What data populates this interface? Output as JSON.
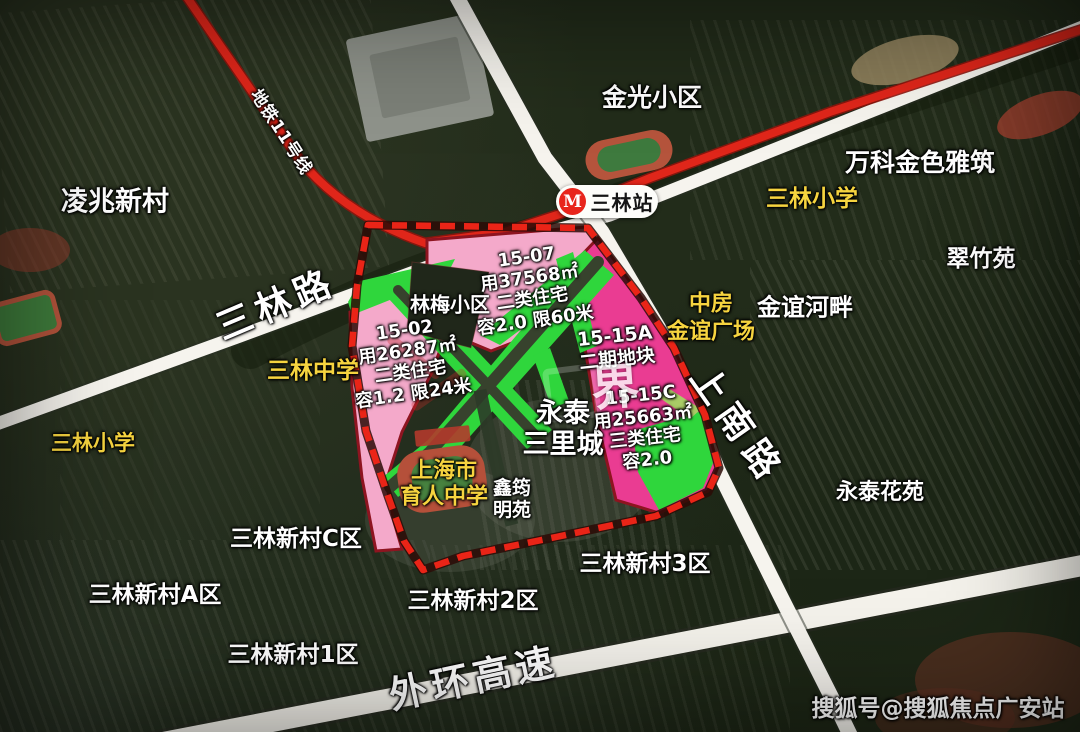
{
  "metro": {
    "line_label": "地铁11号线",
    "station_name": "三林站"
  },
  "roads": [
    {
      "id": "road-sanlin",
      "name": "三林路"
    },
    {
      "id": "road-shangnan",
      "name": "上南路"
    },
    {
      "id": "road-waihuan",
      "name": "外环高速"
    }
  ],
  "parcels": [
    {
      "id": "parcel-15-07",
      "lines": [
        "15-07",
        "用37568㎡",
        "二类住宅",
        "容2.0 限60米"
      ]
    },
    {
      "id": "parcel-15-02",
      "lines": [
        "15-02",
        "用26287㎡",
        "二类住宅",
        "容1.2 限24米"
      ]
    },
    {
      "id": "parcel-15-15A",
      "lines": [
        "15-15A",
        "二期地块"
      ]
    },
    {
      "id": "parcel-15-15C",
      "lines": [
        "15-15C",
        "用25663㎡",
        "三类住宅",
        "容2.0"
      ]
    }
  ],
  "places": [
    {
      "id": "lingzhao-xincun",
      "text": "凌兆新村"
    },
    {
      "id": "jinguang-xiaoqu",
      "text": "金光小区"
    },
    {
      "id": "wanke-jinse-yazhu",
      "text": "万科金色雅筑"
    },
    {
      "id": "sanlin-xiaoxue-east",
      "text": "三林小学",
      "color": "yellow"
    },
    {
      "id": "cuizhu-yuan",
      "text": "翠竹苑"
    },
    {
      "id": "zhongfang-jinyi-guangchang",
      "lines": [
        "中房",
        "金谊广场"
      ],
      "color": "yellow"
    },
    {
      "id": "jinyi-hepan",
      "text": "金谊河畔"
    },
    {
      "id": "linmei-xiaoqu",
      "text": "林梅小区"
    },
    {
      "id": "sanlin-zhongxue",
      "text": "三林中学",
      "color": "yellow"
    },
    {
      "id": "sanlin-xiaoxue-west",
      "text": "三林小学",
      "color": "yellow"
    },
    {
      "id": "yongtai-sanlicheng",
      "lines": [
        "永泰",
        "三里城"
      ]
    },
    {
      "id": "yuren-zhongxue",
      "lines": [
        "上海市",
        "育人中学"
      ],
      "color": "yellow"
    },
    {
      "id": "xinyun-mingyuan",
      "lines": [
        "鑫筠",
        "明苑"
      ]
    },
    {
      "id": "yongtai-huayuan",
      "text": "永泰花苑"
    },
    {
      "id": "xincun-c",
      "text": "三林新村C区"
    },
    {
      "id": "xincun-a",
      "text": "三林新村A区"
    },
    {
      "id": "xincun-3",
      "text": "三林新村3区"
    },
    {
      "id": "xincun-2",
      "text": "三林新村2区"
    },
    {
      "id": "xincun-1",
      "text": "三林新村1区"
    }
  ],
  "watermarks": {
    "center_glyph": "界",
    "bottom_right": "搜狐号@搜狐焦点广安站"
  },
  "colors": {
    "parcel_pink": "#f4a9ca",
    "parcel_magenta": "#ea3c92",
    "greenway": "#2fd63c",
    "metro_red": "#e0261a",
    "boundary_red": "#ea2417",
    "road_white": "#f6f4ee",
    "label_yellow": "#f6d43f"
  }
}
